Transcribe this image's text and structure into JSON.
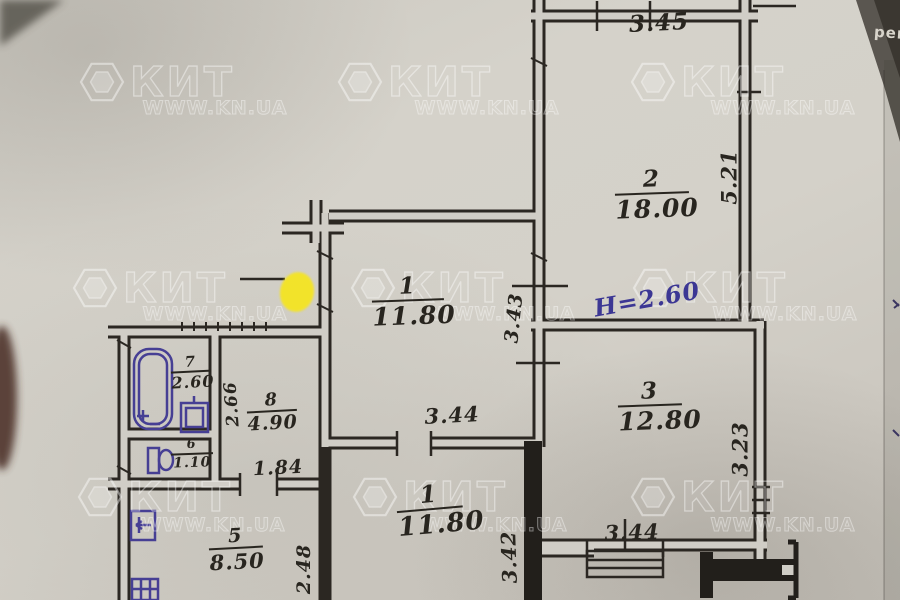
{
  "watermark": {
    "brand": "КИТ",
    "site": "WWW.KN.UA"
  },
  "photo_note": {
    "text": "рем"
  },
  "plan": {
    "height_note": "Н=2.60",
    "rooms": {
      "room2": {
        "num": "2",
        "area": "18.00"
      },
      "room3": {
        "num": "3",
        "area": "12.80"
      },
      "room1": {
        "num": "1",
        "area": "11.80"
      },
      "corridor": {
        "num": "1",
        "area": "11.80"
      },
      "kitchen": {
        "num": "5",
        "area": "8.50"
      },
      "hall8": {
        "num": "8",
        "area": "4.90"
      },
      "bathroom": {
        "num": "7",
        "area": "2.60"
      },
      "wc": {
        "num": "6",
        "area": "1.10"
      }
    },
    "dimensions": {
      "top_width": "3.45",
      "room2_height": "5.21",
      "corridor_wall": "3.43",
      "room3_height": "3.23",
      "hall_width": "3.44",
      "room3_window": "3.44",
      "room1_height": "3.42",
      "kitchen_height": "2.48",
      "bath_wall": "2.66",
      "hall_door": "1.84"
    }
  },
  "colors": {
    "ink": "#28251f",
    "blue_ink": "#463f94",
    "marker_yellow": "#f4e428",
    "paper": "#d0cdc6"
  }
}
